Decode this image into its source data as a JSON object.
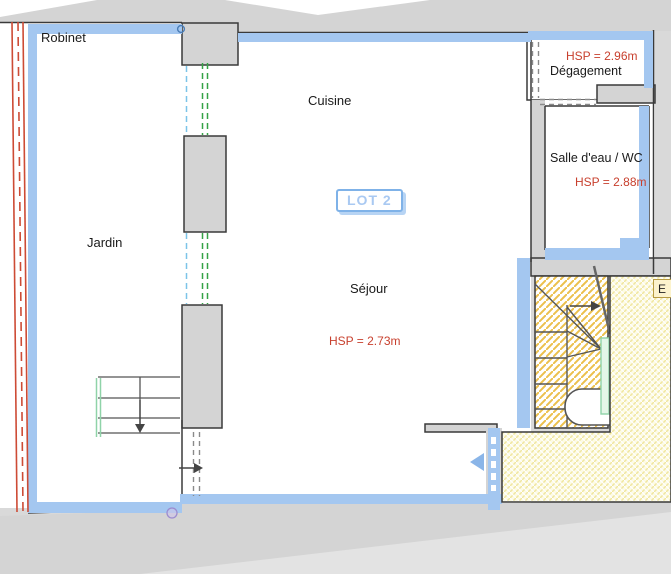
{
  "plan_title": "LOT 2",
  "rooms": {
    "robinet": {
      "label": "Robinet"
    },
    "cuisine": {
      "label": "Cuisine"
    },
    "jardin": {
      "label": "Jardin"
    },
    "sejour": {
      "label": "Séjour",
      "hsp": "HSP = 2.73m"
    },
    "degagement": {
      "label": "Dégagement",
      "hsp": "HSP = 2.96m"
    },
    "salle_eau": {
      "label": "Salle d'eau / WC",
      "hsp": "HSP = 2.88m"
    },
    "escalier": {
      "label": "E"
    }
  },
  "colors": {
    "bg_gray": "#d9d9d9",
    "wall_gray": "#d4d4d4",
    "wall_blue": "#a4c7f0",
    "line_dark": "#3a3a3a",
    "hsp_red": "#c8402e",
    "red_line": "#cd4b35",
    "green_dash": "#35a346",
    "cyan_dash": "#7cc4e8",
    "door_dash": "#8a8a8a",
    "stair_hatch": "#ecc04c",
    "landing_bg": "#fdfbe4",
    "landing_hatch": "#f0e6a0",
    "lot_border": "#7fb2e8",
    "lot_text": "#a9c9f2",
    "green_door": "#8fd3a8",
    "entry_arrow": "#8ab5e8",
    "lavender": "#cfc5ea",
    "ebox_bg": "#fcf3cd",
    "ebox_border": "#b79b43"
  }
}
